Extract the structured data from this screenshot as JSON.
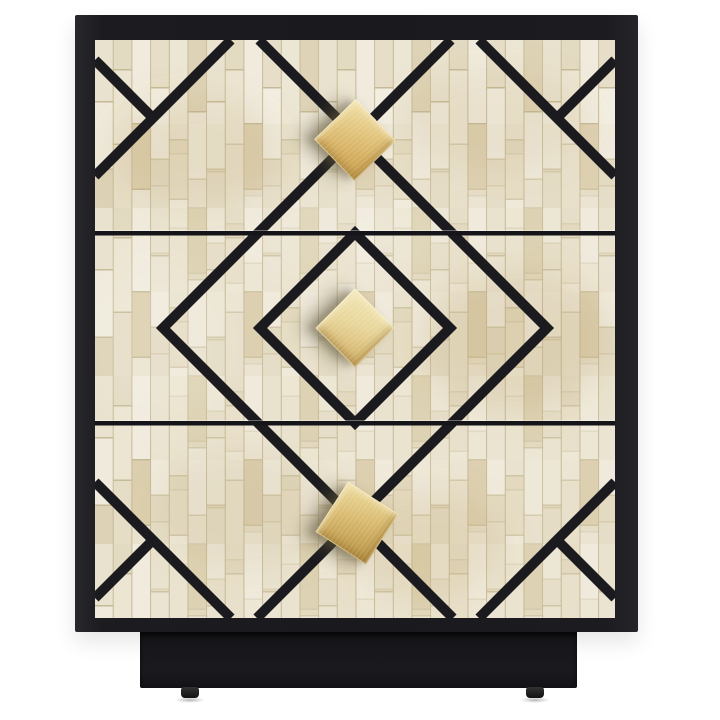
{
  "image": {
    "description": "Product photo: three-drawer bone-inlay nightstand with black lacquer frame, geometric black line pattern and brass square knobs",
    "background": "#ffffff"
  },
  "colors": {
    "frame_black": "#1c1c20",
    "plinth_black": "#17171b",
    "line_art": "#1b1b1f",
    "tile_base": "#e9e2cf",
    "tile_light": "#f1ecdf",
    "tile_dark": "#d8cdaf",
    "tile_joint": "#c7ba98",
    "knob_gold": "#d9ba6f",
    "knob_gold_light": "#f0e0a8",
    "knob_gold_dark": "#b08c3e",
    "knob_shadow": "rgba(96,86,58,0.45)"
  },
  "furniture": {
    "drawer_count": 3,
    "knob_count": 3,
    "feet_count": 2,
    "knob_shape": "tilted brass square",
    "pattern": "concentric diamonds with extended vertices and corner chevrons",
    "material": "bone inlay tile over black lacquer"
  }
}
